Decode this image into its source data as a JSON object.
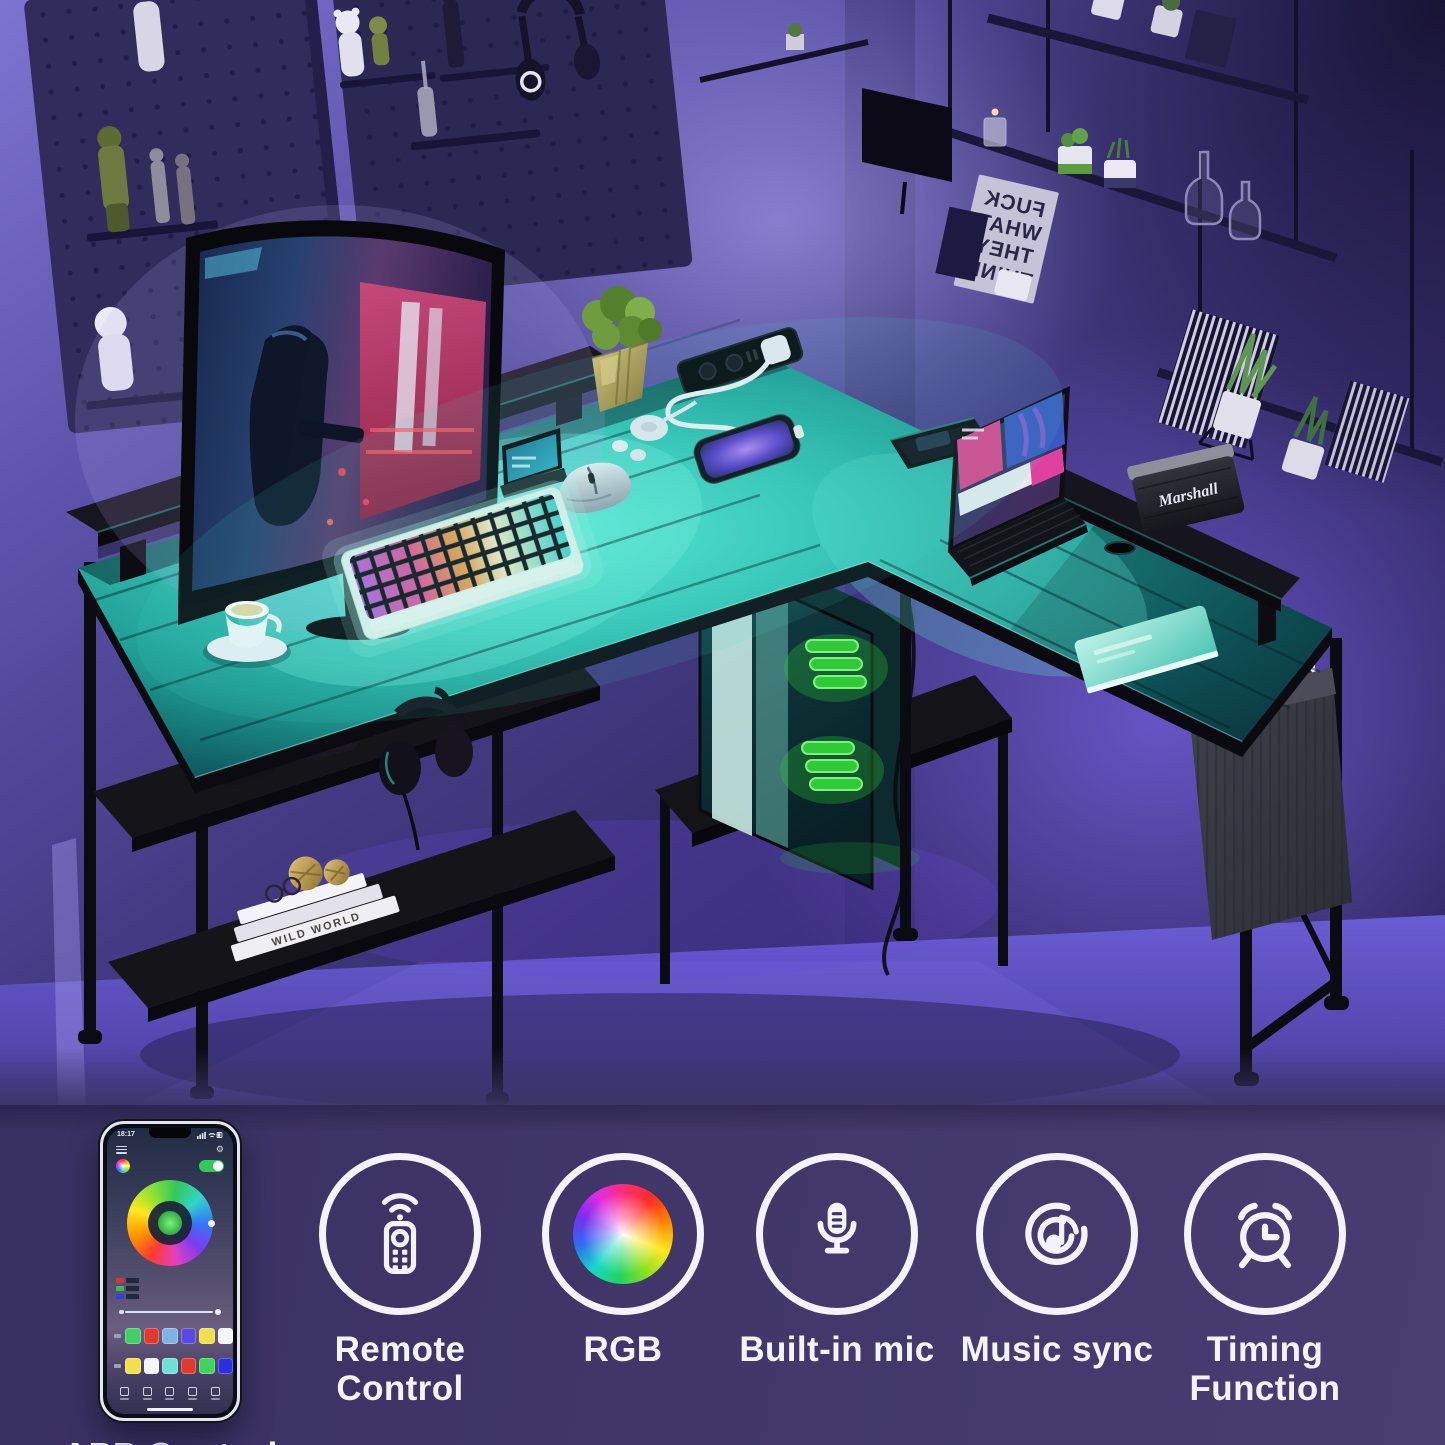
{
  "image": {
    "type": "product-marketing-photo",
    "subject": "L-shaped gaming computer desk with teal LED strip lighting in a dark purple room"
  },
  "strip": {
    "app_control": {
      "label": "APP Control",
      "icon": "smartphone-app-icon"
    },
    "features": [
      {
        "label": "Remote Control",
        "icon": "remote-control-icon"
      },
      {
        "label": "RGB",
        "icon": "rgb-color-wheel-icon"
      },
      {
        "label": "Built-in mic",
        "icon": "microphone-icon"
      },
      {
        "label": "Music sync",
        "icon": "music-sync-icon"
      },
      {
        "label": "Timing Function",
        "icon": "alarm-clock-icon"
      }
    ]
  },
  "phone": {
    "status_time": "18:17",
    "power_toggle": "on",
    "swatch_row1": [
      "#3fcf62",
      "#e03a2e",
      "#7fb3e8",
      "#5a48e0",
      "#f2e04a",
      "#f6f6fa"
    ],
    "swatch_row2": [
      "#f2e04a",
      "#f6f6fa",
      "#6fe0d8",
      "#e03a2e",
      "#3fd45e",
      "#2a2de0"
    ],
    "chip_colors": [
      "#e03030",
      "#30c050",
      "#3040e0"
    ]
  },
  "scene": {
    "poster_lines": [
      "FUCK",
      "WHAT",
      "THEY",
      "THINK"
    ],
    "poster_mirrored": true,
    "speaker_logo": "Marshall",
    "book_spine": "WILD WORLD",
    "colors": {
      "desk_led_glow": "#49e0cf",
      "pc_fan_glow": "#2ecb36",
      "floor": "#5a4dbd",
      "strip_background": "#3e3668",
      "wall": "#4b3f86"
    },
    "objects": [
      "curved gaming monitor with shooter game",
      "RGB mechanical keyboard",
      "wireless gaming mouse",
      "coffee cup on saucer",
      "golden potted plant",
      "smartphone charging on desk",
      "recessed power strip with white plug",
      "wireless charging puck",
      "earbuds",
      "tablet on stand",
      "laptop with keyboard case",
      "Marshall speaker",
      "teal notebook",
      "monitor riser shelves",
      "two game controllers on storage shelf",
      "white books with gold ornaments",
      "headphones hanging on hook",
      "PC tower with green RGB fans",
      "fabric side storage pocket with books",
      "pegboard wall with figurines and headset",
      "hanging wall shelves with plants and bottles",
      "mirrored wall poster"
    ]
  }
}
